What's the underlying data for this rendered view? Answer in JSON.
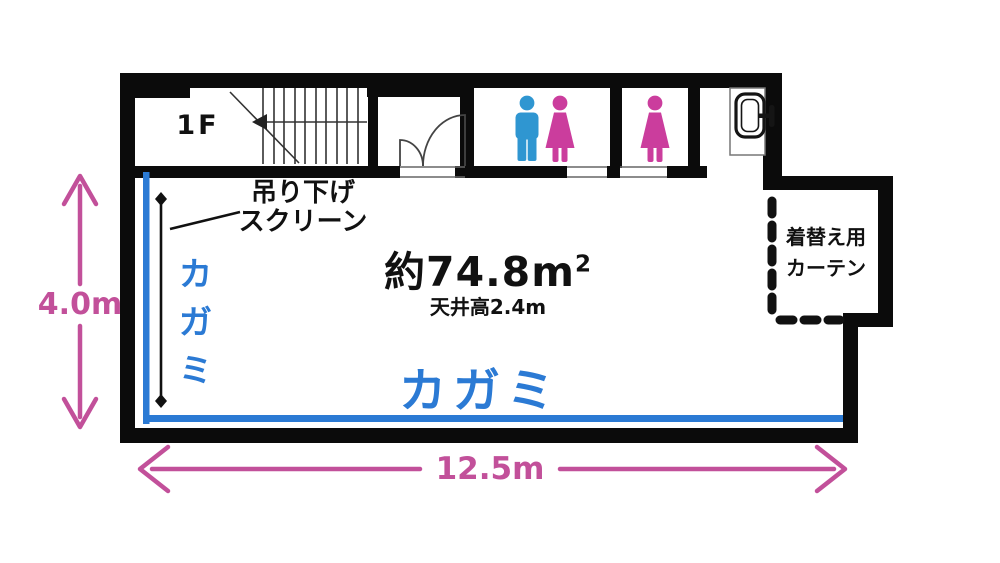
{
  "labels": {
    "floor": "1F",
    "area_main": "約74.8m",
    "area_sup": "2",
    "ceiling": "天井高2.4m",
    "mirror_left": "カガミ",
    "mirror_bottom": "カガミ",
    "screen_line1": "吊り下げ",
    "screen_line2": "スクリーン",
    "curtain_line1": "着替え用",
    "curtain_line2": "カーテン"
  },
  "dimensions": {
    "width": "12.5m",
    "height": "4.0m"
  },
  "icons": {
    "restroom_1": [
      "male-icon",
      "female-icon"
    ],
    "restroom_2": [
      "female-icon"
    ],
    "corner": "sink-icon"
  },
  "colors": {
    "accent_pink": "#c2509a",
    "mirror_blue": "#2b7ad4",
    "male_blue": "#2f96d1",
    "female_pink": "#cb3d9d",
    "wall": "#0b0b0b"
  }
}
